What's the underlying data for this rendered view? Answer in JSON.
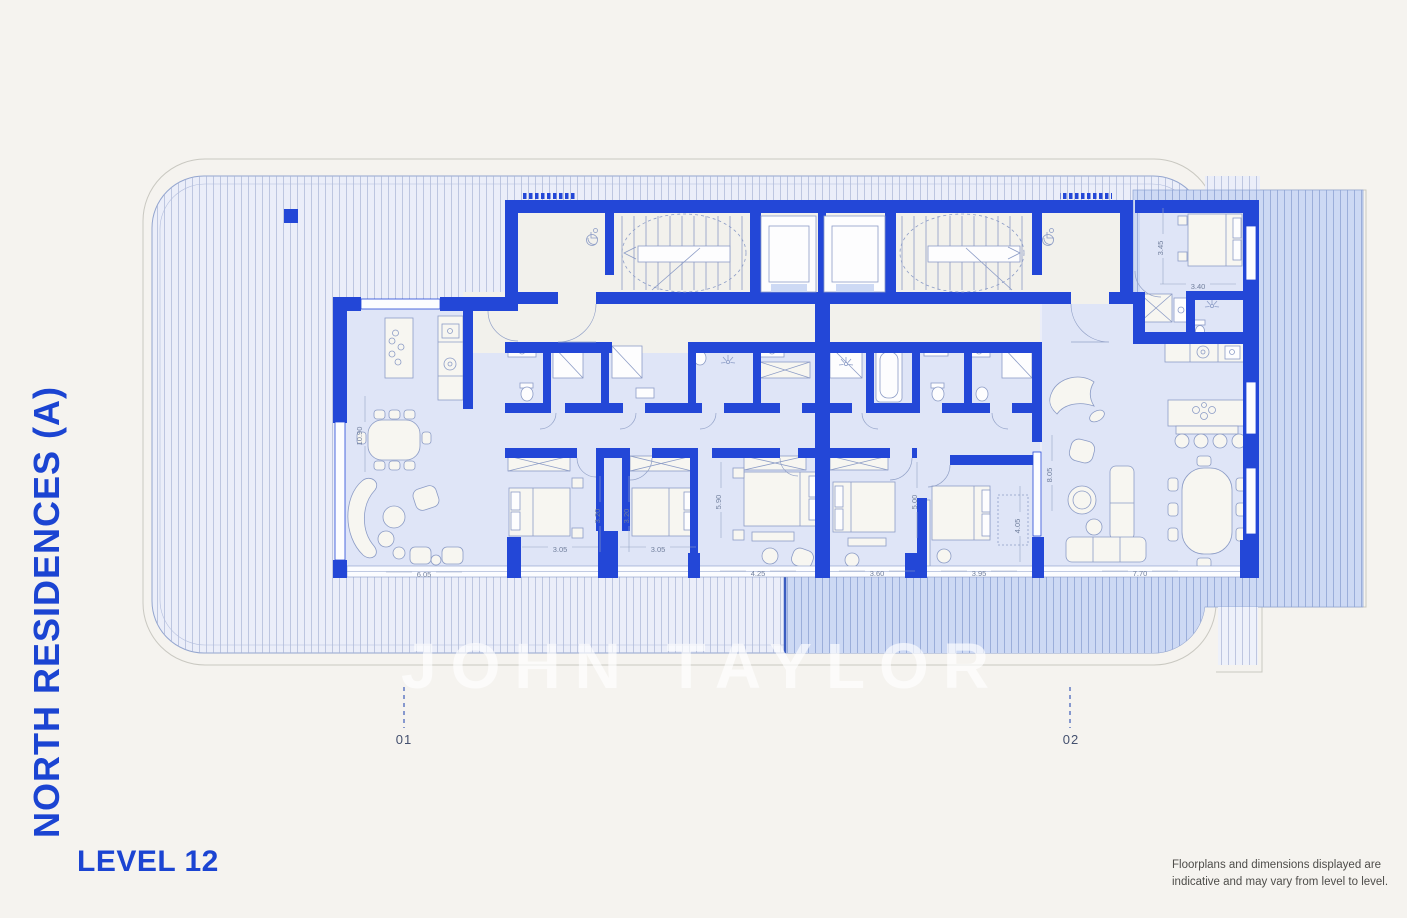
{
  "branding": {
    "project_title": "NORTH RESIDENCES (A)",
    "level_label": "LEVEL 12",
    "watermark_text": "JOHN TAYLOR",
    "accent_color": "#1b44d2"
  },
  "disclaimer": {
    "line1": "Floorplans and dimensions displayed are",
    "line2": "indicative and may vary from level to level."
  },
  "plan": {
    "unit_markers": [
      {
        "id": "01"
      },
      {
        "id": "02"
      }
    ],
    "dimensions": [
      {
        "value": "10.90",
        "orientation": "vertical"
      },
      {
        "value": "6.05",
        "orientation": "horizontal"
      },
      {
        "value": "3.05",
        "orientation": "horizontal"
      },
      {
        "value": "3.20",
        "orientation": "vertical"
      },
      {
        "value": "3.20",
        "orientation": "vertical"
      },
      {
        "value": "3.05",
        "orientation": "horizontal"
      },
      {
        "value": "5.90",
        "orientation": "vertical"
      },
      {
        "value": "4.25",
        "orientation": "horizontal"
      },
      {
        "value": "3.60",
        "orientation": "horizontal"
      },
      {
        "value": "5.00",
        "orientation": "vertical"
      },
      {
        "value": "3.95",
        "orientation": "horizontal"
      },
      {
        "value": "4.05",
        "orientation": "vertical"
      },
      {
        "value": "8.05",
        "orientation": "vertical"
      },
      {
        "value": "7.70",
        "orientation": "horizontal"
      },
      {
        "value": "3.45",
        "orientation": "vertical"
      },
      {
        "value": "3.40",
        "orientation": "horizontal"
      }
    ],
    "colors": {
      "wall_blue": "#2347d7",
      "room_fill": "#dfe5f7",
      "terrace_light": "#ebeef9",
      "terrace_dark": "#cdd9f4",
      "background": "#f5f3ef",
      "dimension_text": "#72809e"
    }
  }
}
